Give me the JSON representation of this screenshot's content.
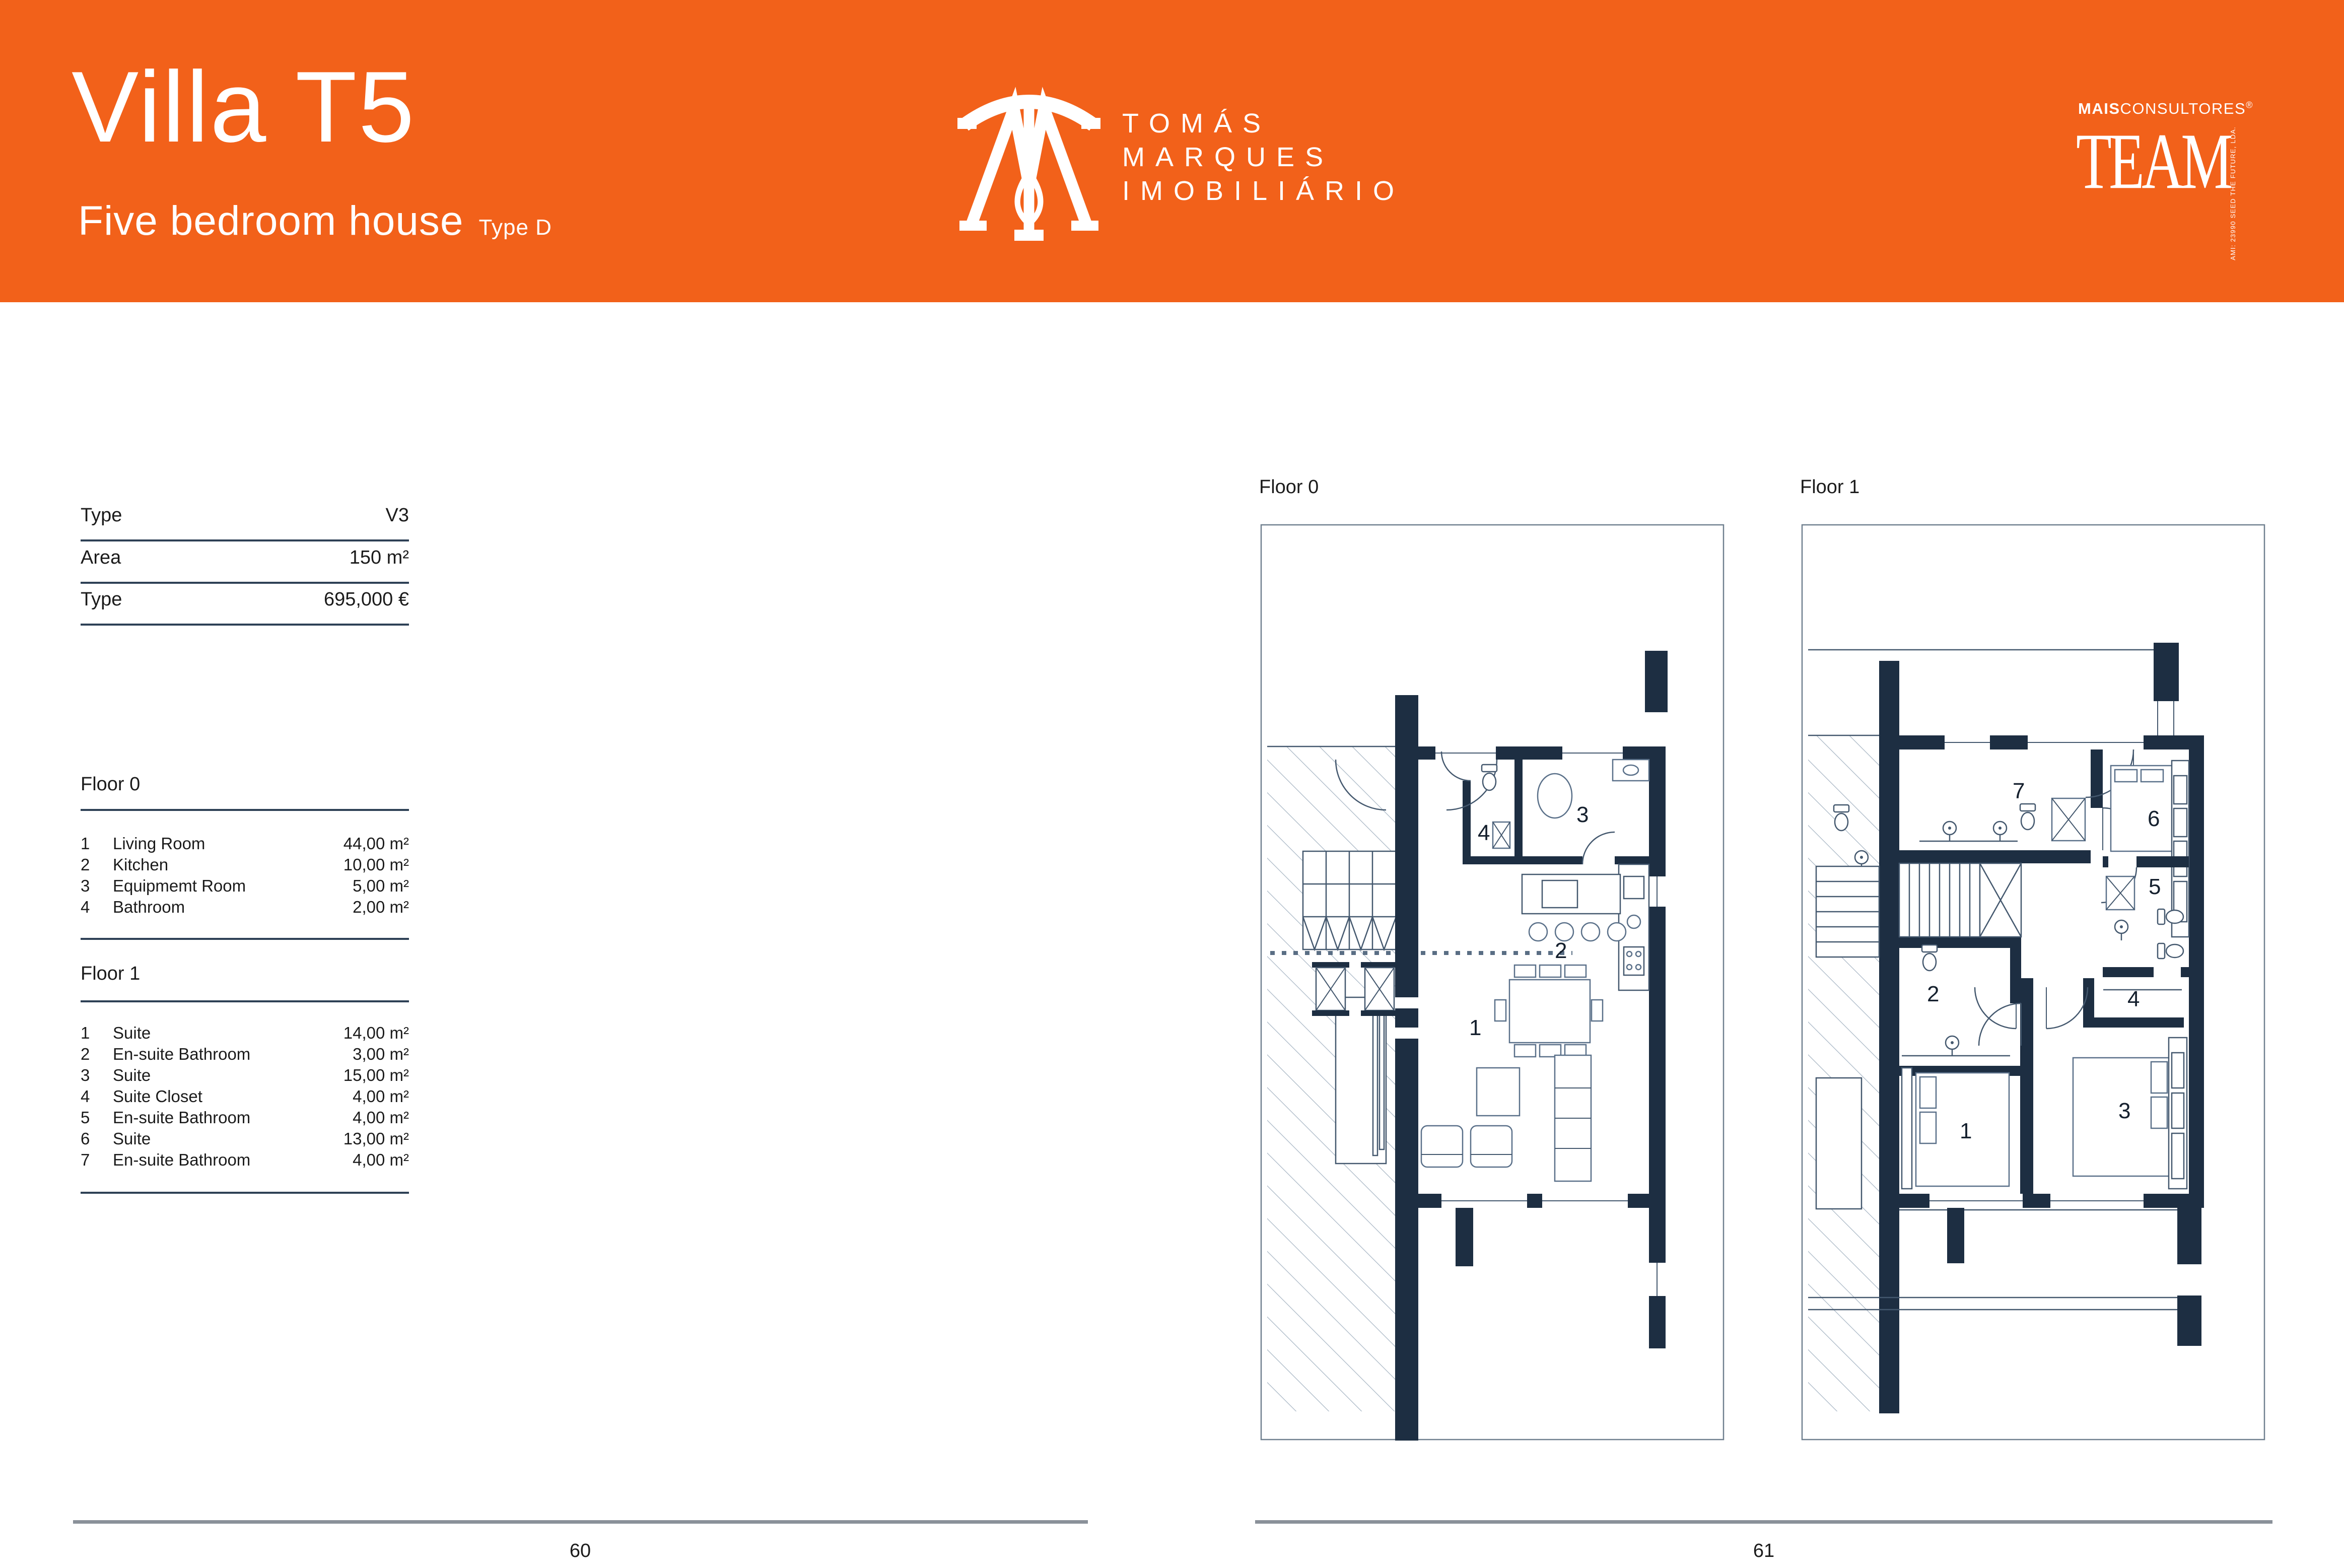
{
  "colors": {
    "accent_orange": "#F2611A",
    "wall_navy": "#1d2e42",
    "rule_navy": "#2e4156",
    "footer_gray": "#8a9199"
  },
  "header": {
    "title": "Villa T5",
    "subtitle": "Five bedroom house",
    "subtitle_suffix": "Type D",
    "brand": {
      "line1": "TOMÁS",
      "line2": "MARQUES",
      "line3": "IMOBILIÁRIO"
    },
    "partner": {
      "prefix_bold": "MAIS",
      "prefix_rest": "CONSULTORES",
      "reg": "®",
      "word": "TEAM",
      "vertical": "AMI: 23990  SEED THE FUTURE, LDA."
    }
  },
  "specs": {
    "rows": [
      {
        "label": "Type",
        "value": "V3"
      },
      {
        "label": "Area",
        "value": "150 m²"
      },
      {
        "label": "Type",
        "value": "695,000 €"
      }
    ]
  },
  "floor0": {
    "title": "Floor 0",
    "rooms": [
      {
        "num": "1",
        "name": "Living Room",
        "area": "44,00 m²"
      },
      {
        "num": "2",
        "name": "Kitchen",
        "area": "10,00 m²"
      },
      {
        "num": "3",
        "name": "Equipmemt Room",
        "area": "5,00 m²"
      },
      {
        "num": "4",
        "name": "Bathroom",
        "area": "2,00 m²"
      }
    ]
  },
  "floor1": {
    "title": "Floor 1",
    "rooms": [
      {
        "num": "1",
        "name": "Suite",
        "area": "14,00 m²"
      },
      {
        "num": "2",
        "name": "En-suite Bathroom",
        "area": "3,00 m²"
      },
      {
        "num": "3",
        "name": "Suite",
        "area": "15,00 m²"
      },
      {
        "num": "4",
        "name": "Suite Closet",
        "area": "4,00 m²"
      },
      {
        "num": "5",
        "name": "En-suite Bathroom",
        "area": "4,00 m²"
      },
      {
        "num": "6",
        "name": "Suite",
        "area": "13,00 m²"
      },
      {
        "num": "7",
        "name": "En-suite Bathroom",
        "area": "4,00 m²"
      }
    ]
  },
  "plans": {
    "floor0": {
      "label": "Floor 0",
      "room_numbers": [
        "1",
        "2",
        "3",
        "4"
      ]
    },
    "floor1": {
      "label": "Floor 1",
      "room_numbers": [
        "1",
        "2",
        "3",
        "4",
        "5",
        "6",
        "7"
      ]
    }
  },
  "footer": {
    "left_page": "60",
    "right_page": "61"
  }
}
